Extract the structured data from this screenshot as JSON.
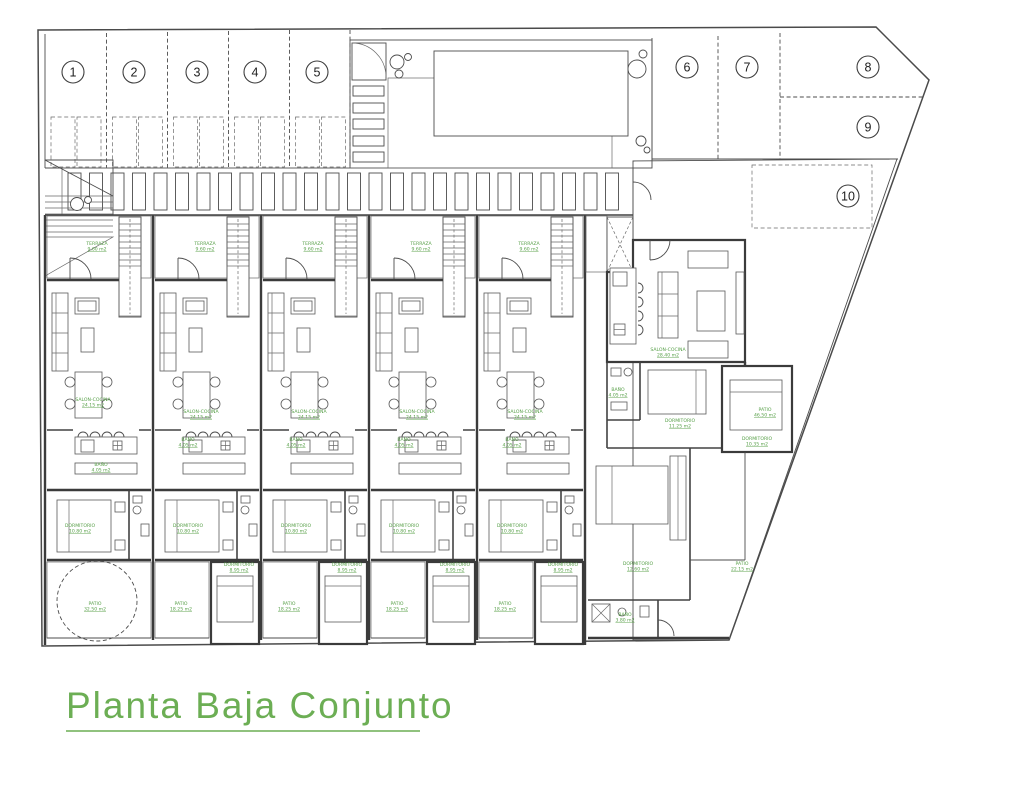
{
  "title": {
    "text": "Planta Baja Conjunto"
  },
  "colors": {
    "background": "#ffffff",
    "line": "#4a4a4a",
    "hatch": "#9b9b9b",
    "label_green": "#58a049",
    "title_green": "#6cae54"
  },
  "plan": {
    "parking_spots": [
      {
        "n": "1",
        "x": 73,
        "y": 72
      },
      {
        "n": "2",
        "x": 134,
        "y": 72
      },
      {
        "n": "3",
        "x": 197,
        "y": 72
      },
      {
        "n": "4",
        "x": 255,
        "y": 72
      },
      {
        "n": "5",
        "x": 317,
        "y": 72
      },
      {
        "n": "6",
        "x": 687,
        "y": 67
      },
      {
        "n": "7",
        "x": 747,
        "y": 67
      },
      {
        "n": "8",
        "x": 868,
        "y": 67
      },
      {
        "n": "9",
        "x": 868,
        "y": 127
      },
      {
        "n": "10",
        "x": 848,
        "y": 196
      }
    ],
    "room_labels": [
      {
        "name": "TERRAZA",
        "area": "9.60 m2",
        "x": 97,
        "y": 245
      },
      {
        "name": "TERRAZA",
        "area": "9.60 m2",
        "x": 205,
        "y": 245
      },
      {
        "name": "TERRAZA",
        "area": "9.60 m2",
        "x": 313,
        "y": 245
      },
      {
        "name": "TERRAZA",
        "area": "9.60 m2",
        "x": 421,
        "y": 245
      },
      {
        "name": "TERRAZA",
        "area": "9.60 m2",
        "x": 529,
        "y": 245
      },
      {
        "name": "SALON-COCINA",
        "area": "24.15 m2",
        "x": 93,
        "y": 401
      },
      {
        "name": "SALON-COCINA",
        "area": "24.15 m2",
        "x": 201,
        "y": 413
      },
      {
        "name": "SALON-COCINA",
        "area": "24.15 m2",
        "x": 309,
        "y": 413
      },
      {
        "name": "SALON-COCINA",
        "area": "24.15 m2",
        "x": 417,
        "y": 413
      },
      {
        "name": "SALON-COCINA",
        "area": "24.15 m2",
        "x": 525,
        "y": 413
      },
      {
        "name": "SALON-COCINA",
        "area": "28.40 m2",
        "x": 668,
        "y": 351
      },
      {
        "name": "DORMITORIO",
        "area": "10.80 m2",
        "x": 80,
        "y": 527
      },
      {
        "name": "DORMITORIO",
        "area": "10.80 m2",
        "x": 188,
        "y": 527
      },
      {
        "name": "DORMITORIO",
        "area": "10.80 m2",
        "x": 296,
        "y": 527
      },
      {
        "name": "DORMITORIO",
        "area": "10.80 m2",
        "x": 404,
        "y": 527
      },
      {
        "name": "DORMITORIO",
        "area": "10.80 m2",
        "x": 512,
        "y": 527
      },
      {
        "name": "DORMITORIO",
        "area": "8.95 m2",
        "x": 239,
        "y": 566
      },
      {
        "name": "DORMITORIO",
        "area": "8.95 m2",
        "x": 347,
        "y": 566
      },
      {
        "name": "DORMITORIO",
        "area": "8.95 m2",
        "x": 455,
        "y": 566
      },
      {
        "name": "DORMITORIO",
        "area": "8.95 m2",
        "x": 563,
        "y": 566
      },
      {
        "name": "DORMITORIO",
        "area": "11.25 m2",
        "x": 680,
        "y": 422
      },
      {
        "name": "DORMITORIO",
        "area": "10.35 m2",
        "x": 757,
        "y": 440
      },
      {
        "name": "DORMITORIO",
        "area": "12.60 m2",
        "x": 638,
        "y": 565
      },
      {
        "name": "BAÑO",
        "area": "4.05 m2",
        "x": 101,
        "y": 466
      },
      {
        "name": "BAÑO",
        "area": "4.05 m2",
        "x": 188,
        "y": 441
      },
      {
        "name": "BAÑO",
        "area": "4.05 m2",
        "x": 296,
        "y": 441
      },
      {
        "name": "BAÑO",
        "area": "4.05 m2",
        "x": 404,
        "y": 441
      },
      {
        "name": "BAÑO",
        "area": "4.05 m2",
        "x": 512,
        "y": 441
      },
      {
        "name": "BAÑO",
        "area": "4.05 m2",
        "x": 618,
        "y": 391
      },
      {
        "name": "BAÑO",
        "area": "3.80 m2",
        "x": 625,
        "y": 616
      },
      {
        "name": "PATIO",
        "area": "32.50 m2",
        "x": 95,
        "y": 605
      },
      {
        "name": "PATIO",
        "area": "18.25 m2",
        "x": 181,
        "y": 605
      },
      {
        "name": "PATIO",
        "area": "18.25 m2",
        "x": 289,
        "y": 605
      },
      {
        "name": "PATIO",
        "area": "18.25 m2",
        "x": 397,
        "y": 605
      },
      {
        "name": "PATIO",
        "area": "18.25 m2",
        "x": 505,
        "y": 605
      },
      {
        "name": "PATIO",
        "area": "46.50 m2",
        "x": 765,
        "y": 411
      },
      {
        "name": "PATIO",
        "area": "22.15 m2",
        "x": 742,
        "y": 565
      }
    ]
  }
}
